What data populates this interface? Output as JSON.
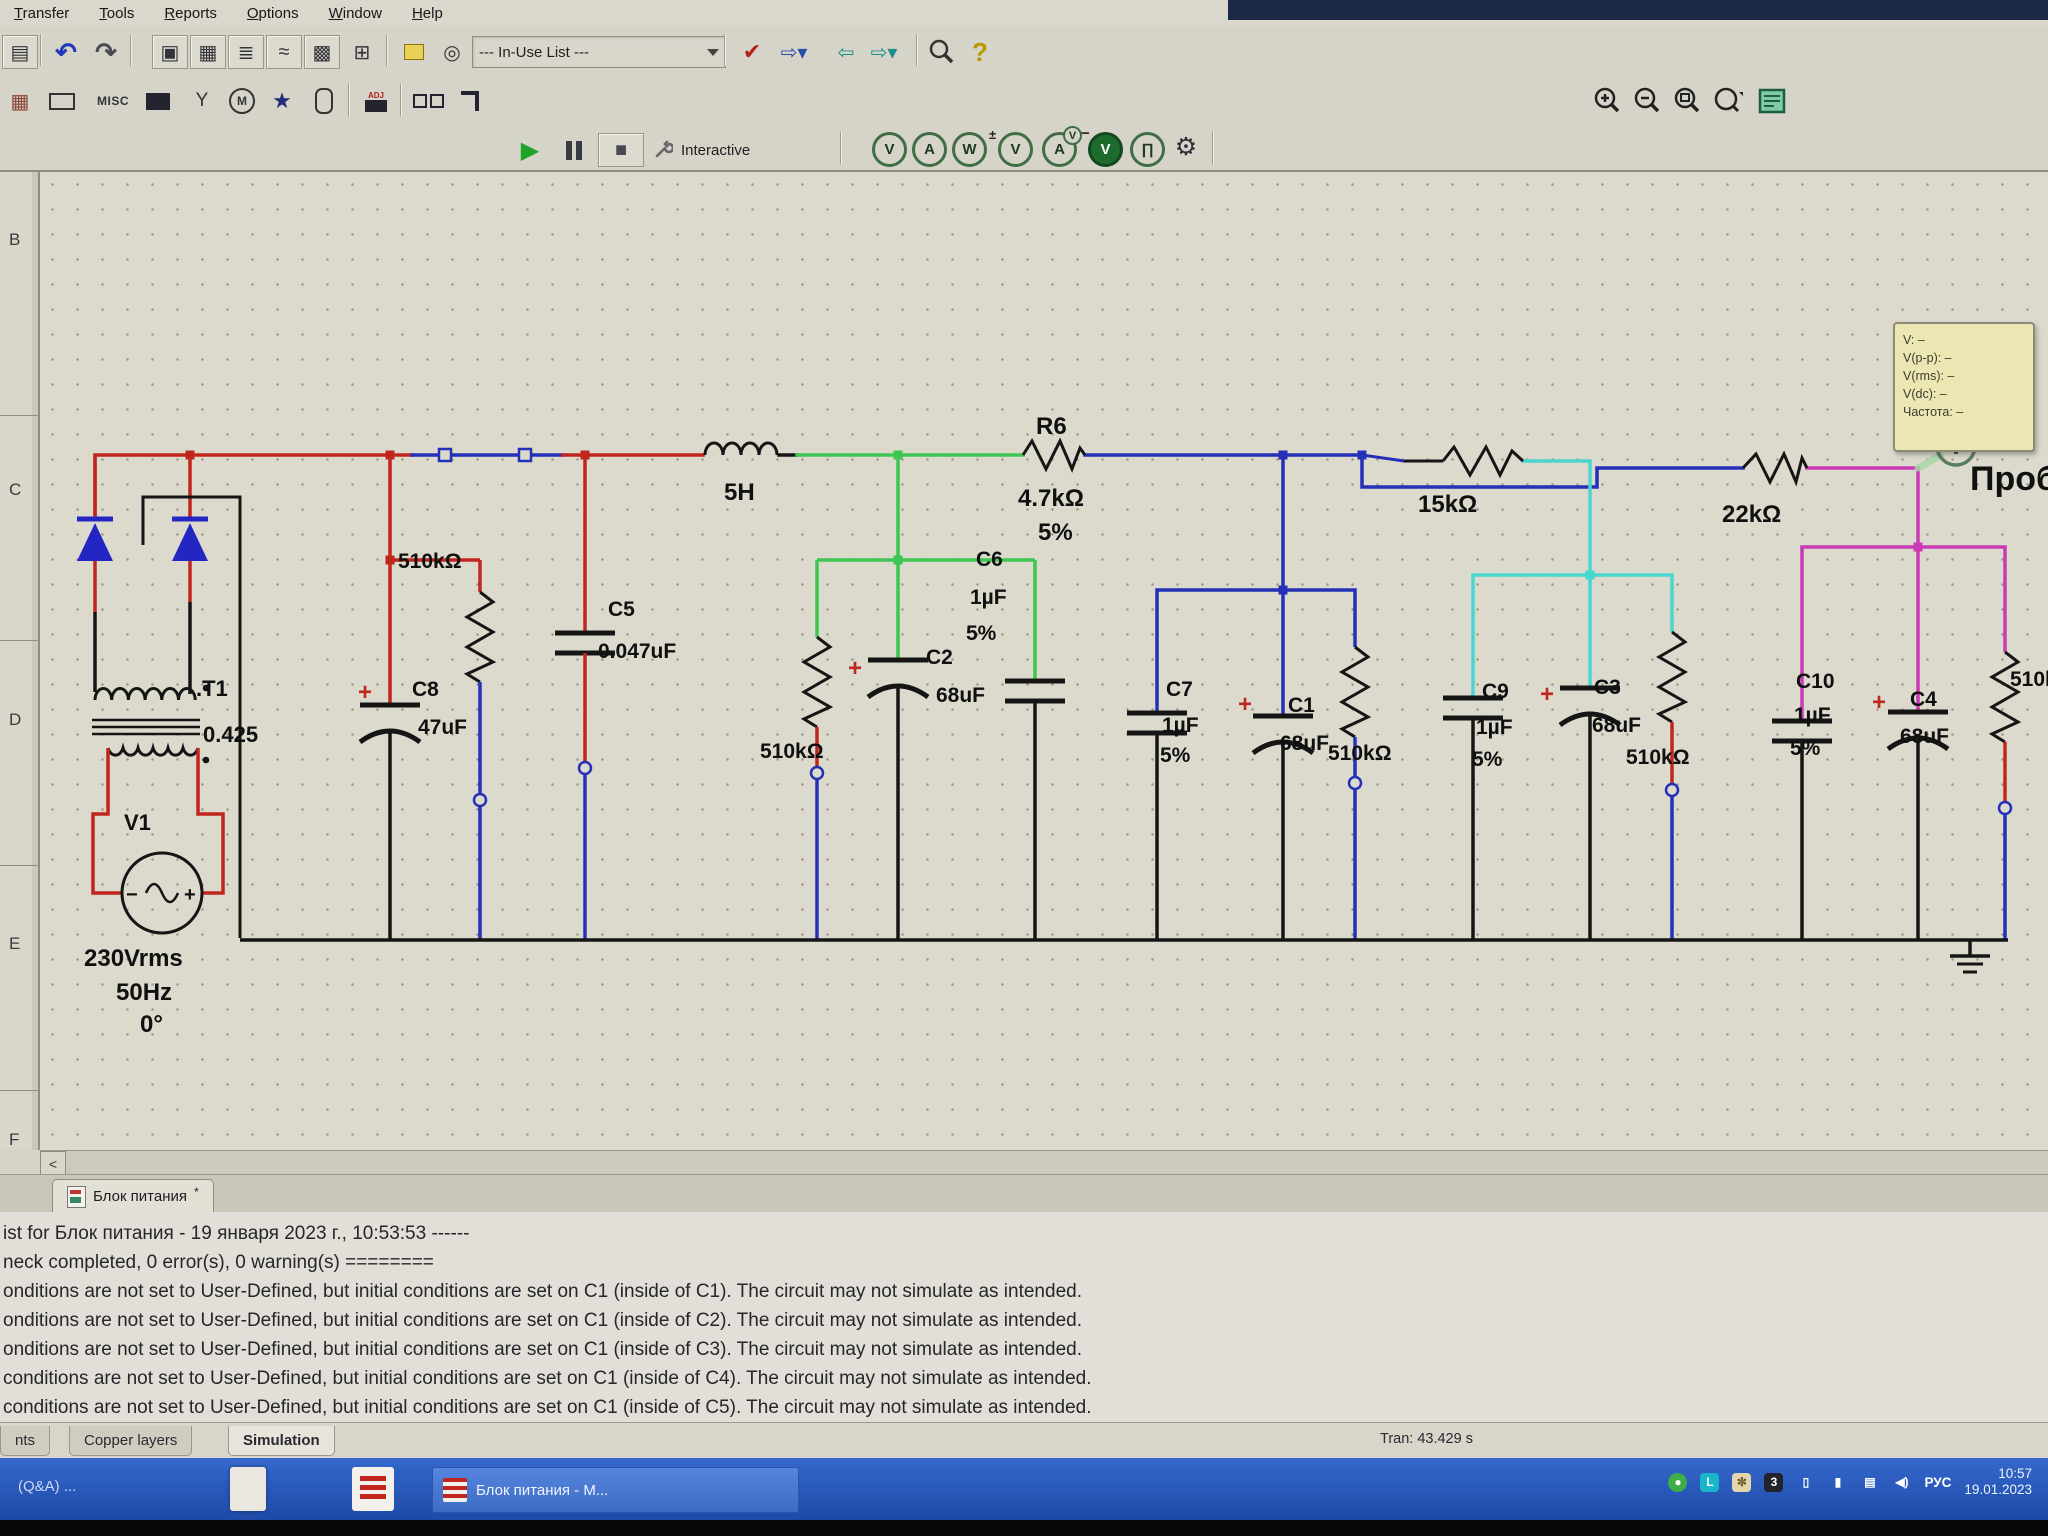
{
  "chrome": {
    "menu_items": [
      "Transfer",
      "Tools",
      "Reports",
      "Options",
      "Window",
      "Help"
    ],
    "in_use_list": "--- In-Use List ---",
    "interactive_label": "Interactive",
    "misc_label": "MISC",
    "adj_label": "ADJ",
    "ruler_letters": [
      "B",
      "C",
      "D",
      "E",
      "F"
    ],
    "scroll_left_arrow": "<"
  },
  "icons": {
    "undo": "↶",
    "redo": "↷",
    "play": "▶",
    "stop": "■",
    "help": "?",
    "check": "✔",
    "gear": "⚙",
    "probe_v": "V",
    "probe_a": "A",
    "probe_w": "W",
    "probe_pulse": "∏"
  },
  "probe_tooltip": {
    "lines": [
      "V: –",
      "V(p-p): –",
      "V(rms): –",
      "V(dc): –",
      "Частота: –"
    ]
  },
  "circuit": {
    "labels": [
      {
        "t": ".T1",
        "x": 196,
        "y": 696,
        "s": 22
      },
      {
        "t": "0.425",
        "x": 203,
        "y": 742,
        "s": 22
      },
      {
        "t": "V1",
        "x": 124,
        "y": 830,
        "s": 22
      },
      {
        "t": "230Vrms",
        "x": 84,
        "y": 966,
        "s": 24
      },
      {
        "t": "50Hz",
        "x": 116,
        "y": 1000,
        "s": 24
      },
      {
        "t": "0°",
        "x": 140,
        "y": 1032,
        "s": 24
      },
      {
        "t": "−",
        "x": 126,
        "y": 901,
        "s": 20
      },
      {
        "t": "+",
        "x": 184,
        "y": 901,
        "s": 20
      },
      {
        "t": "510kΩ",
        "x": 398,
        "y": 568
      },
      {
        "t": "C5",
        "x": 608,
        "y": 616
      },
      {
        "t": "0.047uF",
        "x": 598,
        "y": 658
      },
      {
        "t": "C8",
        "x": 412,
        "y": 696
      },
      {
        "t": "47uF",
        "x": 418,
        "y": 734
      },
      {
        "t": "+",
        "x": 358,
        "y": 700,
        "s": 24,
        "c": "#c0261d"
      },
      {
        "t": "5H",
        "x": 724,
        "y": 500,
        "s": 24
      },
      {
        "t": "510kΩ",
        "x": 760,
        "y": 758
      },
      {
        "t": "C2",
        "x": 926,
        "y": 664
      },
      {
        "t": "68uF",
        "x": 936,
        "y": 702
      },
      {
        "t": "+",
        "x": 848,
        "y": 676,
        "s": 24,
        "c": "#c0261d"
      },
      {
        "t": "C6",
        "x": 976,
        "y": 566
      },
      {
        "t": "1µF",
        "x": 970,
        "y": 604
      },
      {
        "t": "5%",
        "x": 966,
        "y": 640
      },
      {
        "t": "R6",
        "x": 1036,
        "y": 434,
        "s": 24
      },
      {
        "t": "4.7kΩ",
        "x": 1018,
        "y": 506,
        "s": 24
      },
      {
        "t": "5%",
        "x": 1038,
        "y": 540,
        "s": 24
      },
      {
        "t": "C7",
        "x": 1166,
        "y": 696
      },
      {
        "t": "1µF",
        "x": 1162,
        "y": 732
      },
      {
        "t": "5%",
        "x": 1160,
        "y": 762
      },
      {
        "t": "C1",
        "x": 1288,
        "y": 712
      },
      {
        "t": "68uF",
        "x": 1280,
        "y": 750
      },
      {
        "t": "+",
        "x": 1238,
        "y": 712,
        "s": 24,
        "c": "#c0261d"
      },
      {
        "t": "510kΩ",
        "x": 1328,
        "y": 760
      },
      {
        "t": "15kΩ",
        "x": 1418,
        "y": 512,
        "s": 24
      },
      {
        "t": "C9",
        "x": 1482,
        "y": 698
      },
      {
        "t": "1µF",
        "x": 1476,
        "y": 734
      },
      {
        "t": "5%",
        "x": 1472,
        "y": 766
      },
      {
        "t": "C3",
        "x": 1594,
        "y": 694
      },
      {
        "t": "68uF",
        "x": 1592,
        "y": 732
      },
      {
        "t": "+",
        "x": 1540,
        "y": 702,
        "s": 24,
        "c": "#c0261d"
      },
      {
        "t": "510kΩ",
        "x": 1626,
        "y": 764
      },
      {
        "t": "22kΩ",
        "x": 1722,
        "y": 522,
        "s": 24
      },
      {
        "t": "C10",
        "x": 1796,
        "y": 688
      },
      {
        "t": "1µF",
        "x": 1794,
        "y": 722
      },
      {
        "t": "5%",
        "x": 1790,
        "y": 755
      },
      {
        "t": "C4",
        "x": 1910,
        "y": 706
      },
      {
        "t": "68uF",
        "x": 1900,
        "y": 743
      },
      {
        "t": "+",
        "x": 1872,
        "y": 710,
        "s": 24,
        "c": "#c0261d"
      },
      {
        "t": "510kΩ",
        "x": 2010,
        "y": 686
      },
      {
        "t": "Проб",
        "x": 1970,
        "y": 490,
        "s": 34
      }
    ]
  },
  "design_tab": {
    "label": "Блок питания",
    "dirty_mark": "*"
  },
  "log": {
    "lines": [
      "ist for Блок питания - 19 января 2023 г., 10:53:53 ------",
      "neck completed, 0 error(s), 0 warning(s) ========",
      "onditions are not set to User-Defined, but initial conditions are set on C1 (inside of C1). The circuit may not simulate as intended.",
      "onditions are not set to User-Defined, but initial conditions are set on C1 (inside of C2). The circuit may not simulate as intended.",
      "onditions are not set to User-Defined, but initial conditions are set on C1 (inside of C3). The circuit may not simulate as intended.",
      "conditions are not set to User-Defined, but initial conditions are set on C1 (inside of C4). The circuit may not simulate as intended.",
      "conditions are not set to User-Defined, but initial conditions are set on C1 (inside of C5). The circuit may not simulate as intended."
    ]
  },
  "status": {
    "tran": "Tran: 43.429 s"
  },
  "bottom_tabs": {
    "items": [
      "nts",
      "Copper layers",
      "Simulation"
    ],
    "active": "Simulation"
  },
  "taskbar": {
    "qa_label": "(Q&A) ...",
    "task_label": "Блок питания - M...",
    "lang": "РУС",
    "time": "10:57",
    "date": "19.01.2023"
  }
}
